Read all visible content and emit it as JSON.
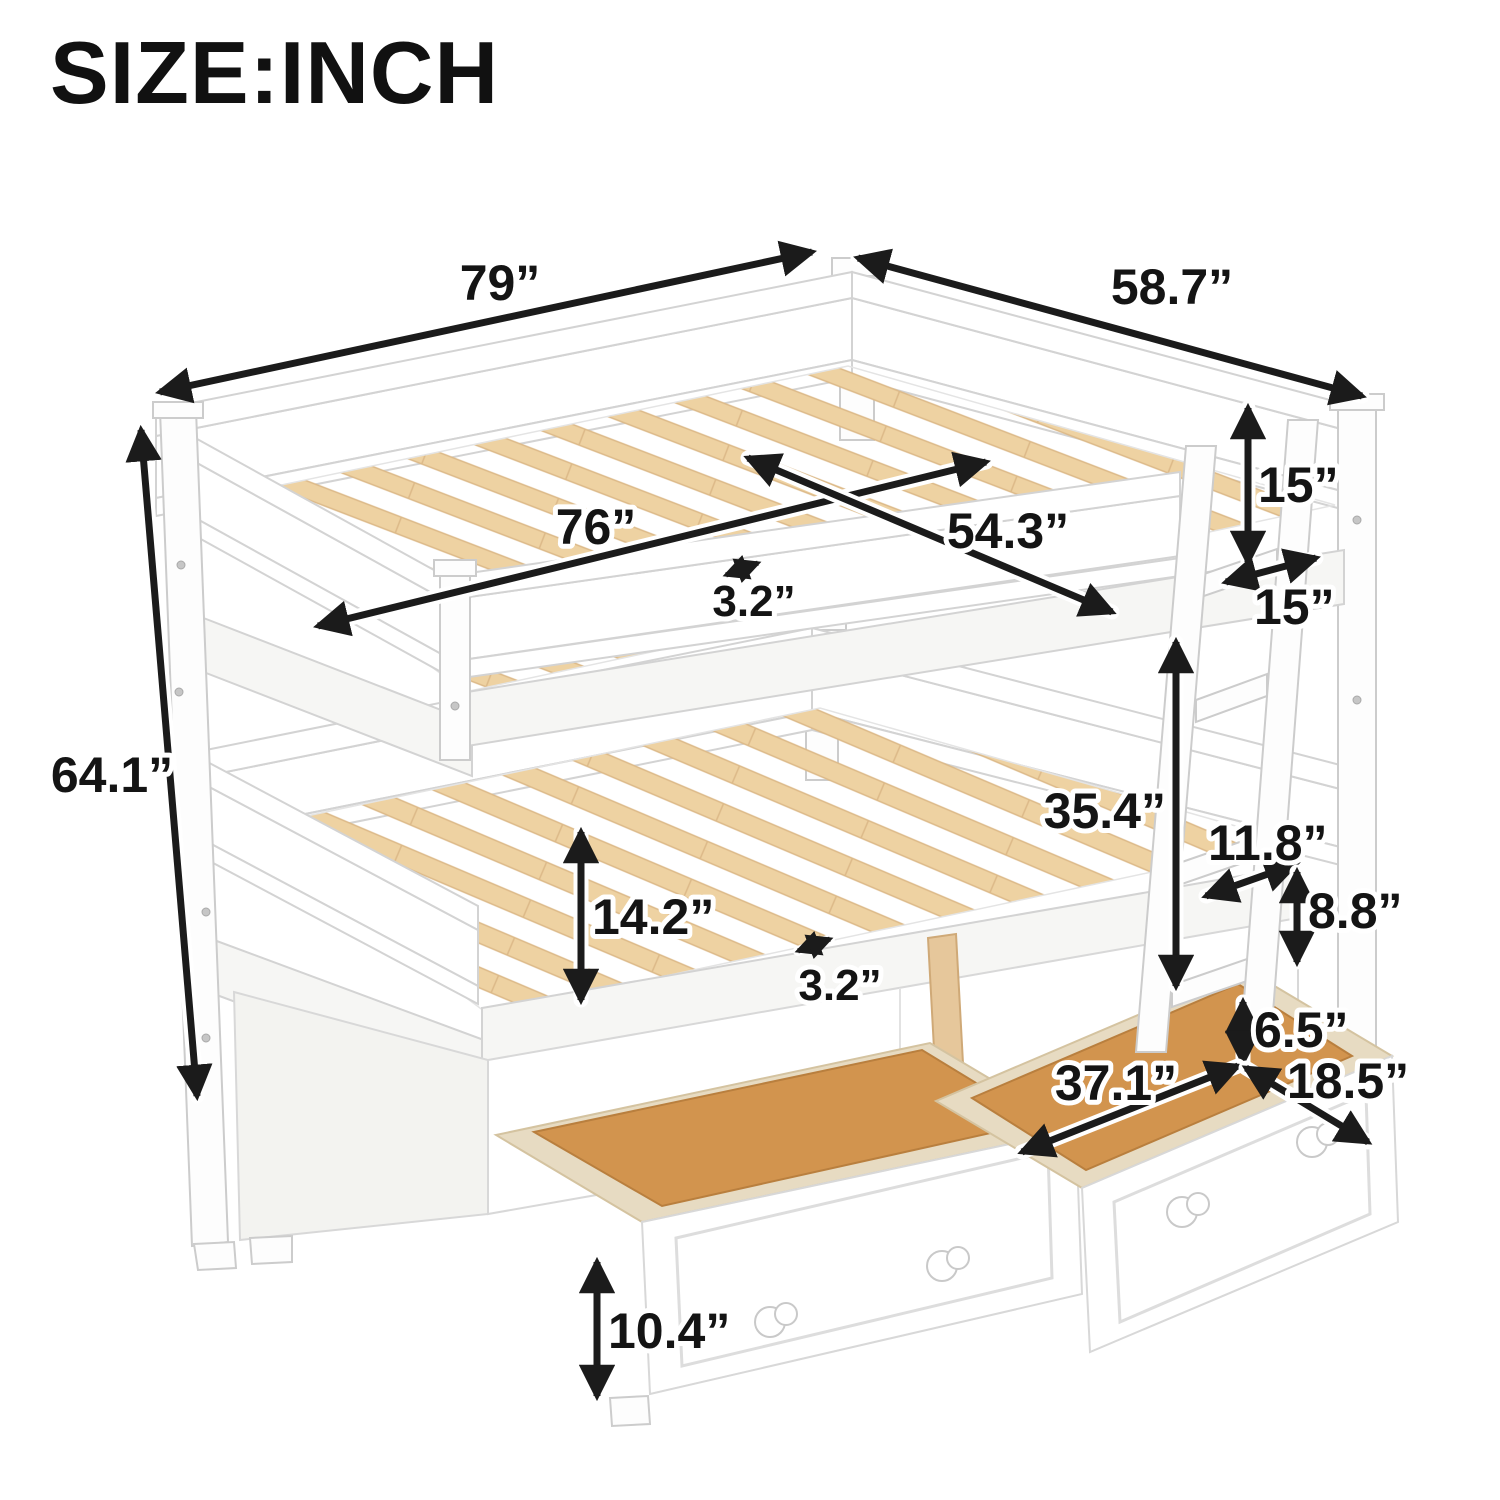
{
  "title": "SIZE:INCH",
  "colors": {
    "slat_wood": "#eed2a2",
    "drawer_wood": "#d2944e",
    "frame_white": "#ffffff",
    "dimension_ink": "#1b1b1b"
  },
  "dimensions": {
    "overall_length": "79”",
    "overall_depth": "58.7”",
    "overall_height": "64.1”",
    "slat_length": "76”",
    "upper_inner_width": "54.3”",
    "upper_slat_gap": "3.2”",
    "upper_rail_height": "15”",
    "ladder_width": "15”",
    "bunk_clearance": "35.4”",
    "ladder_rung_spacing": "11.8”",
    "ladder_bottom_rung": "8.8”",
    "lower_side_height": "14.2”",
    "lower_slat_gap": "3.2”",
    "under_bed_clearance": "6.5”",
    "drawer_width": "37.1”",
    "drawer_depth": "18.5”",
    "drawer_height": "10.4”"
  }
}
